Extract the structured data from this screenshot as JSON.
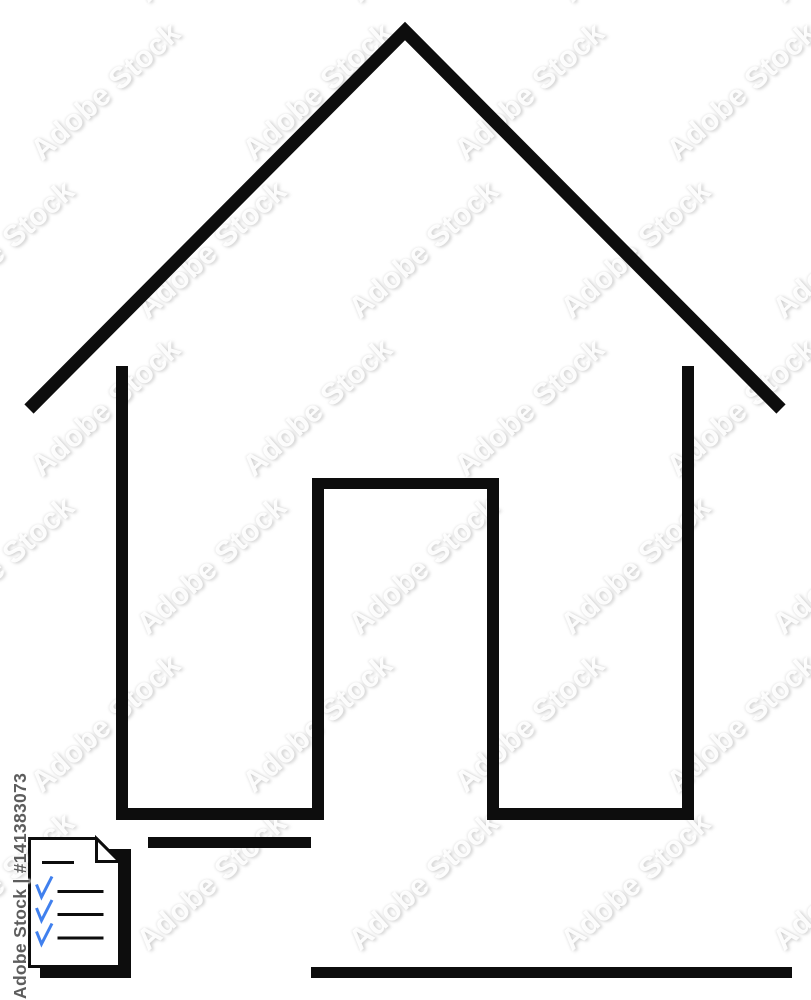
{
  "artwork": {
    "title": "House outline with checklist document",
    "background_color": "#ffffff",
    "line_color": "#0d0d0d",
    "page_fill_color": "#ffffff",
    "check_color": "#4080ee",
    "checklist": {
      "header_lines": 1,
      "checked_rows": 3
    }
  },
  "watermark": {
    "tile_text": "Adobe Stock",
    "credit_text": "Adobe Stock | #141383073",
    "credit_color": "#5d5d5d"
  }
}
